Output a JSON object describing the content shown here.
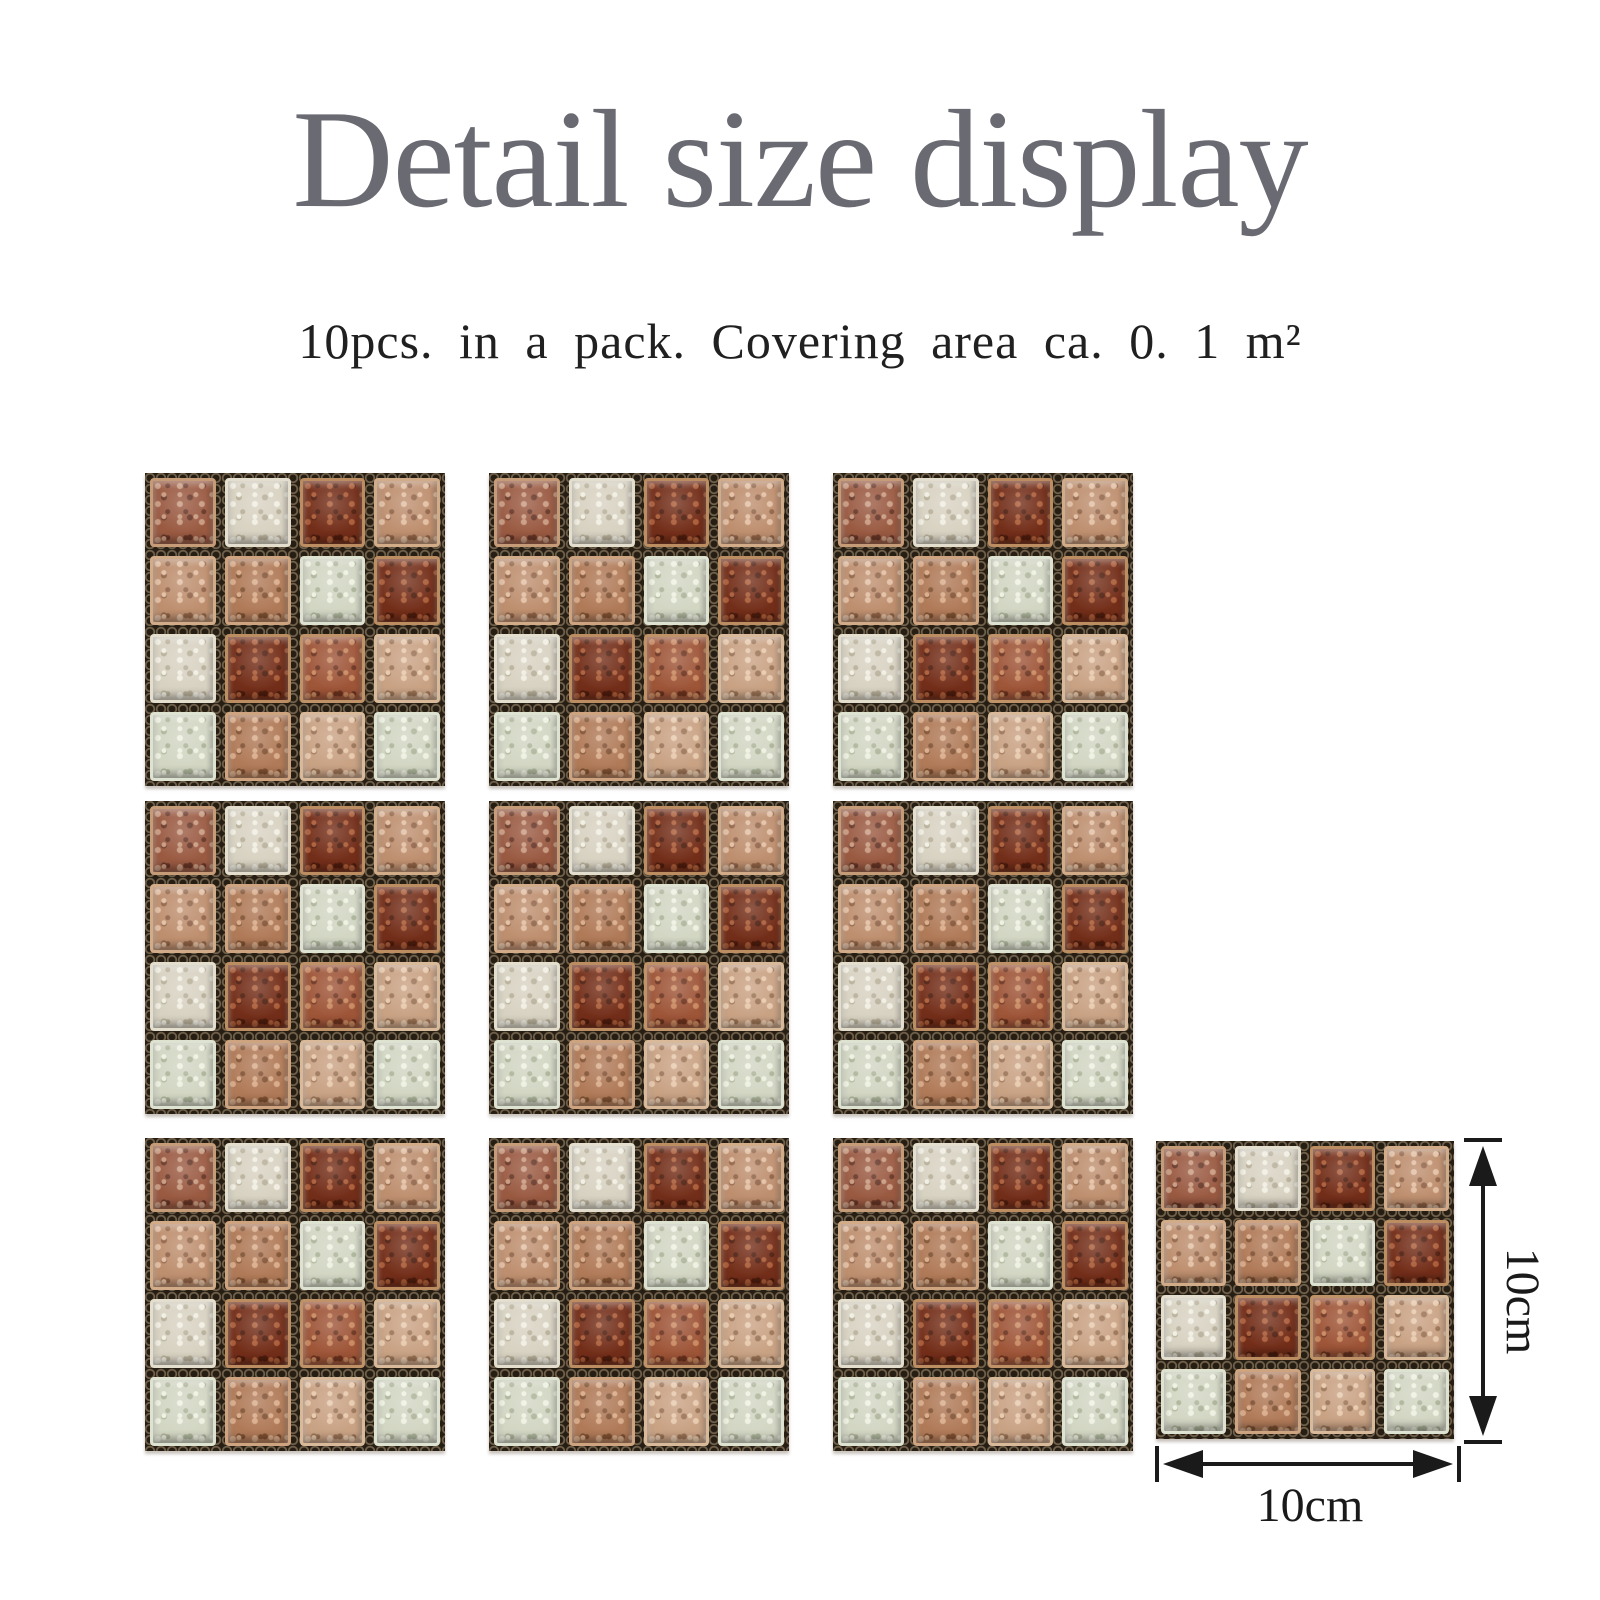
{
  "page": {
    "background_color": "#ffffff"
  },
  "header": {
    "title": "Detail size display",
    "title_color": "#6a6a73",
    "subtitle": "10pcs. in a pack. Covering area ca. 0. 1 m²",
    "subtitle_color": "#202020"
  },
  "pack": {
    "tile_count": 10,
    "covering_area_label": "0.1 m²"
  },
  "dimensions": {
    "height_label": "10cm",
    "width_label": "10cm",
    "annotation_color": "#1a1a1a"
  },
  "mosaic": {
    "grid_rows": 4,
    "grid_cols": 4,
    "grout_color": "#261d13",
    "grout_mesh_color": "#9d8a6d",
    "pattern": [
      [
        "brown",
        "cream",
        "darkred",
        "tan"
      ],
      [
        "tan",
        "midbrown",
        "palegreen",
        "darkred"
      ],
      [
        "cream",
        "darkred",
        "redbrown",
        "lighttan"
      ],
      [
        "palegreen",
        "midbrown",
        "lighttan",
        "palegreen"
      ]
    ],
    "palette": {
      "brown": {
        "base": "#9a5a42",
        "light": "#c89a80",
        "dark": "#643425",
        "rim": "#c69c78"
      },
      "cream": {
        "base": "#d8d2c2",
        "light": "#f1eee2",
        "dark": "#b6ae98",
        "rim": "#e3decd"
      },
      "darkred": {
        "base": "#732e19",
        "light": "#aa5c38",
        "dark": "#4c1c0d",
        "rim": "#bd8d62"
      },
      "tan": {
        "base": "#be8f6f",
        "light": "#e2bfa3",
        "dark": "#8f6246",
        "rim": "#d2ab89"
      },
      "midbrown": {
        "base": "#b07a58",
        "light": "#d8ab89",
        "dark": "#7e5031",
        "rim": "#cda380"
      },
      "palegreen": {
        "base": "#d2d6c3",
        "light": "#eef1e1",
        "dark": "#acb399",
        "rim": "#dee2d0"
      },
      "redbrown": {
        "base": "#9e5538",
        "light": "#c8885f",
        "dark": "#6a321e",
        "rim": "#c09267"
      },
      "lighttan": {
        "base": "#c9a284",
        "light": "#e7c9ad",
        "dark": "#997254",
        "rim": "#d8ba9b"
      }
    }
  }
}
